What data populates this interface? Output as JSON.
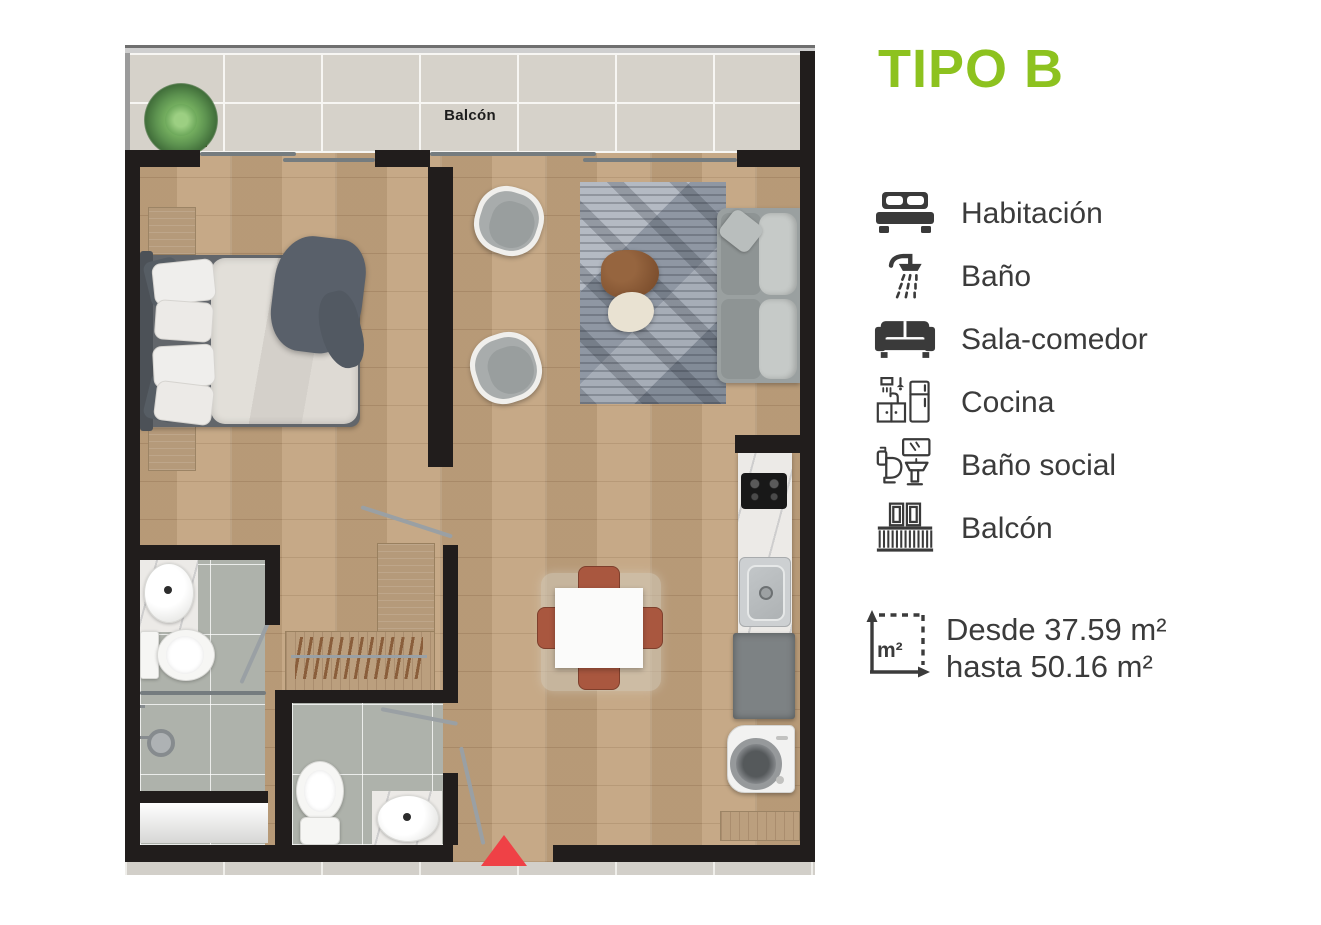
{
  "title": "TIPO B",
  "colors": {
    "accent_green": "#8dc21f",
    "text_dark": "#3b3b3b",
    "wall": "#211d1c",
    "red_marker": "#ef4146"
  },
  "floor_plan": {
    "balcony_label": "Balcón",
    "entrance_marker": "red-triangle"
  },
  "legend": {
    "items": [
      {
        "icon": "bed-icon",
        "label": "Habitación"
      },
      {
        "icon": "shower-icon",
        "label": "Baño"
      },
      {
        "icon": "sofa-icon",
        "label": "Sala-comedor"
      },
      {
        "icon": "kitchen-icon",
        "label": "Cocina"
      },
      {
        "icon": "toilet-sink-icon",
        "label": "Baño social"
      },
      {
        "icon": "balcony-railing-icon",
        "label": "Balcón"
      }
    ]
  },
  "area_info": {
    "icon": "m2-area-icon",
    "icon_label": "m²",
    "line1": "Desde 37.59 m²",
    "line2": "hasta 50.16 m²"
  }
}
